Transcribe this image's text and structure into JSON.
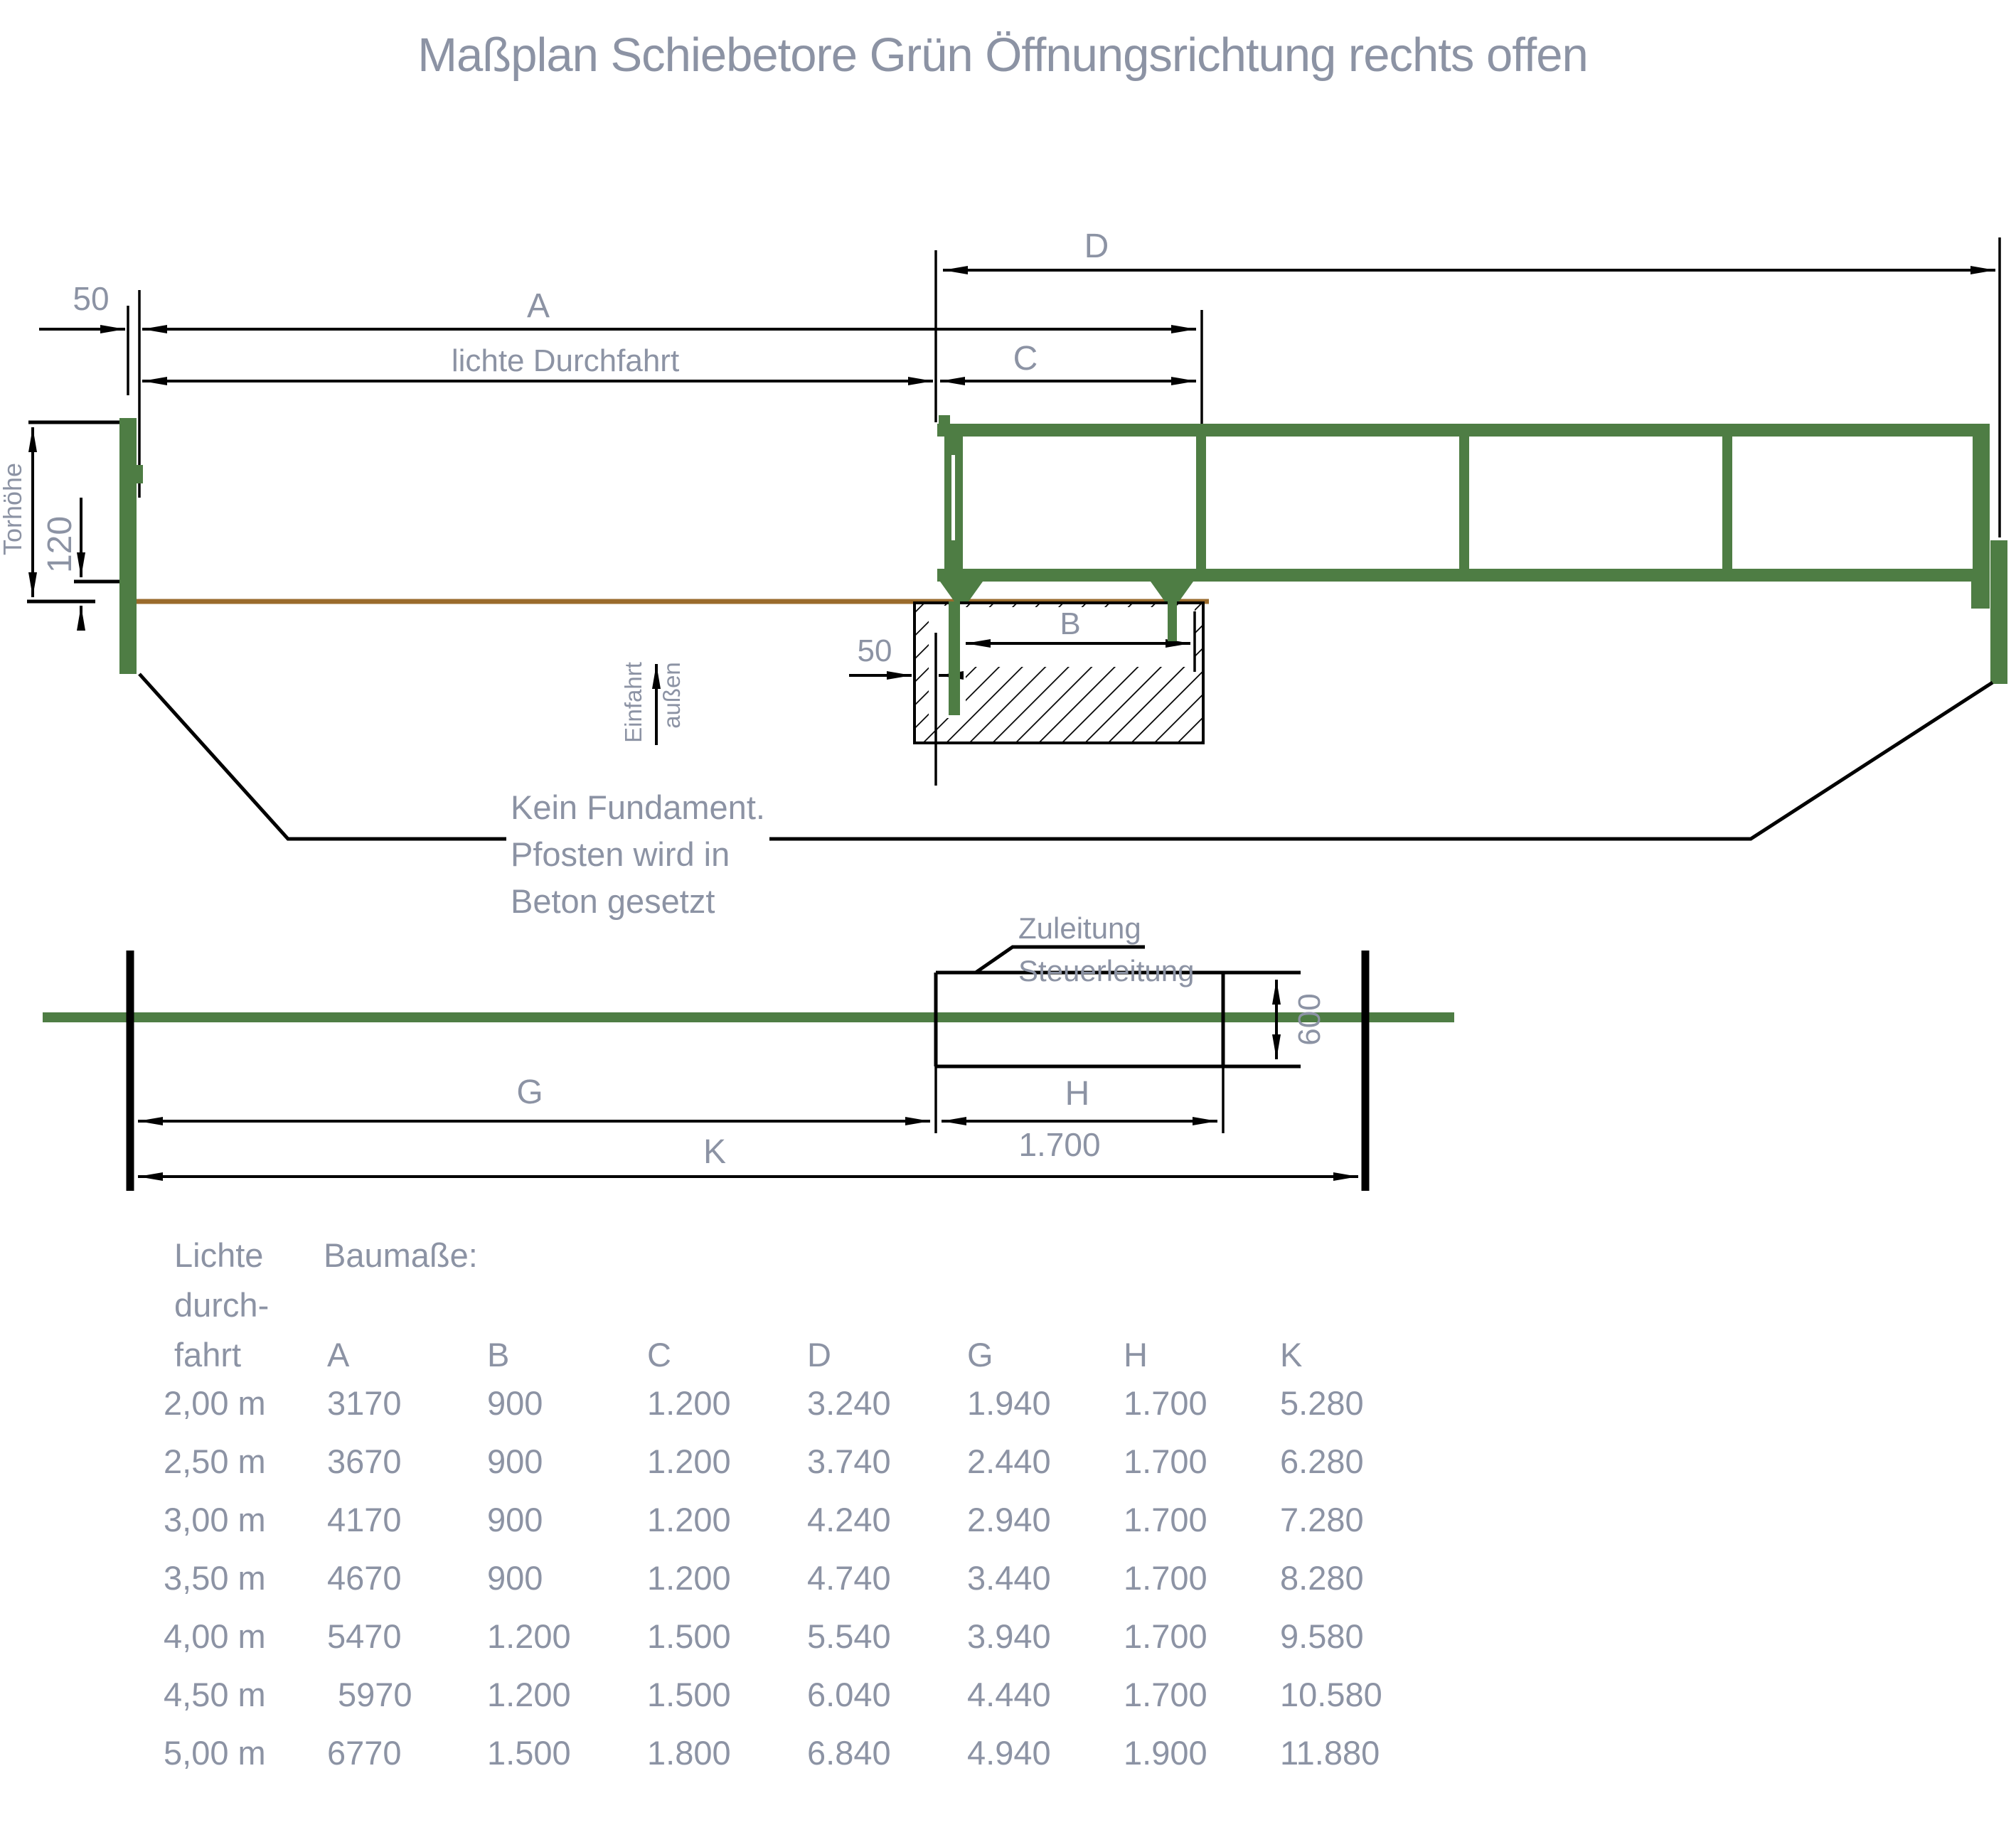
{
  "title": "Maßplan Schiebetore Grün Öffnungsrichtung rechts offen",
  "colors": {
    "gate_green": "#4e7d44",
    "ground_brown": "#9a6b2c",
    "text_gray": "#8c93a4",
    "line_black": "#000000"
  },
  "side_view": {
    "dim_d": "D",
    "dim_a": "A",
    "dim_c": "C",
    "dim_b": "B",
    "dim_50_post": "50",
    "dim_50_foundation": "50",
    "dim_clear_width": "lichte Durchfahrt",
    "dim_gate_height": "Torhöhe",
    "dim_ground_clearance": "120",
    "dir_einfahrt": "Einfahrt",
    "dir_aussen": "außen",
    "note_line1": "Kein Fundament.",
    "note_line2": "Pfosten wird in",
    "note_line3": "Beton gesetzt"
  },
  "plan_view": {
    "label_supply": "Zuleitung",
    "label_control": "Steuerleitung",
    "dim_600": "600",
    "dim_g": "G",
    "dim_h": "H",
    "dim_h_value": "1.700",
    "dim_k": "K"
  },
  "table": {
    "row_header_line1": "Lichte",
    "row_header_line2": "durch-",
    "row_header_line3": "fahrt",
    "group_header": "Baumaße:",
    "columns": [
      "A",
      "B",
      "C",
      "D",
      "G",
      "H",
      "K"
    ],
    "rows": [
      [
        "2,00 m",
        "3170",
        "900",
        "1.200",
        "3.240",
        "1.940",
        "1.700",
        "5.280"
      ],
      [
        "2,50 m",
        "3670",
        "900",
        "1.200",
        "3.740",
        "2.440",
        "1.700",
        "6.280"
      ],
      [
        "3,00 m",
        "4170",
        "900",
        "1.200",
        "4.240",
        "2.940",
        "1.700",
        "7.280"
      ],
      [
        "3,50 m",
        "4670",
        "900",
        "1.200",
        "4.740",
        "3.440",
        "1.700",
        "8.280"
      ],
      [
        "4,00 m",
        "5470",
        "1.200",
        "1.500",
        "5.540",
        "3.940",
        "1.700",
        "9.580"
      ],
      [
        "4,50 m",
        "5970",
        "1.200",
        "1.500",
        "6.040",
        "4.440",
        "1.700",
        "10.580"
      ],
      [
        "5,00 m",
        "6770",
        "1.500",
        "1.800",
        "6.840",
        "4.940",
        "1.900",
        "11.880"
      ]
    ]
  }
}
